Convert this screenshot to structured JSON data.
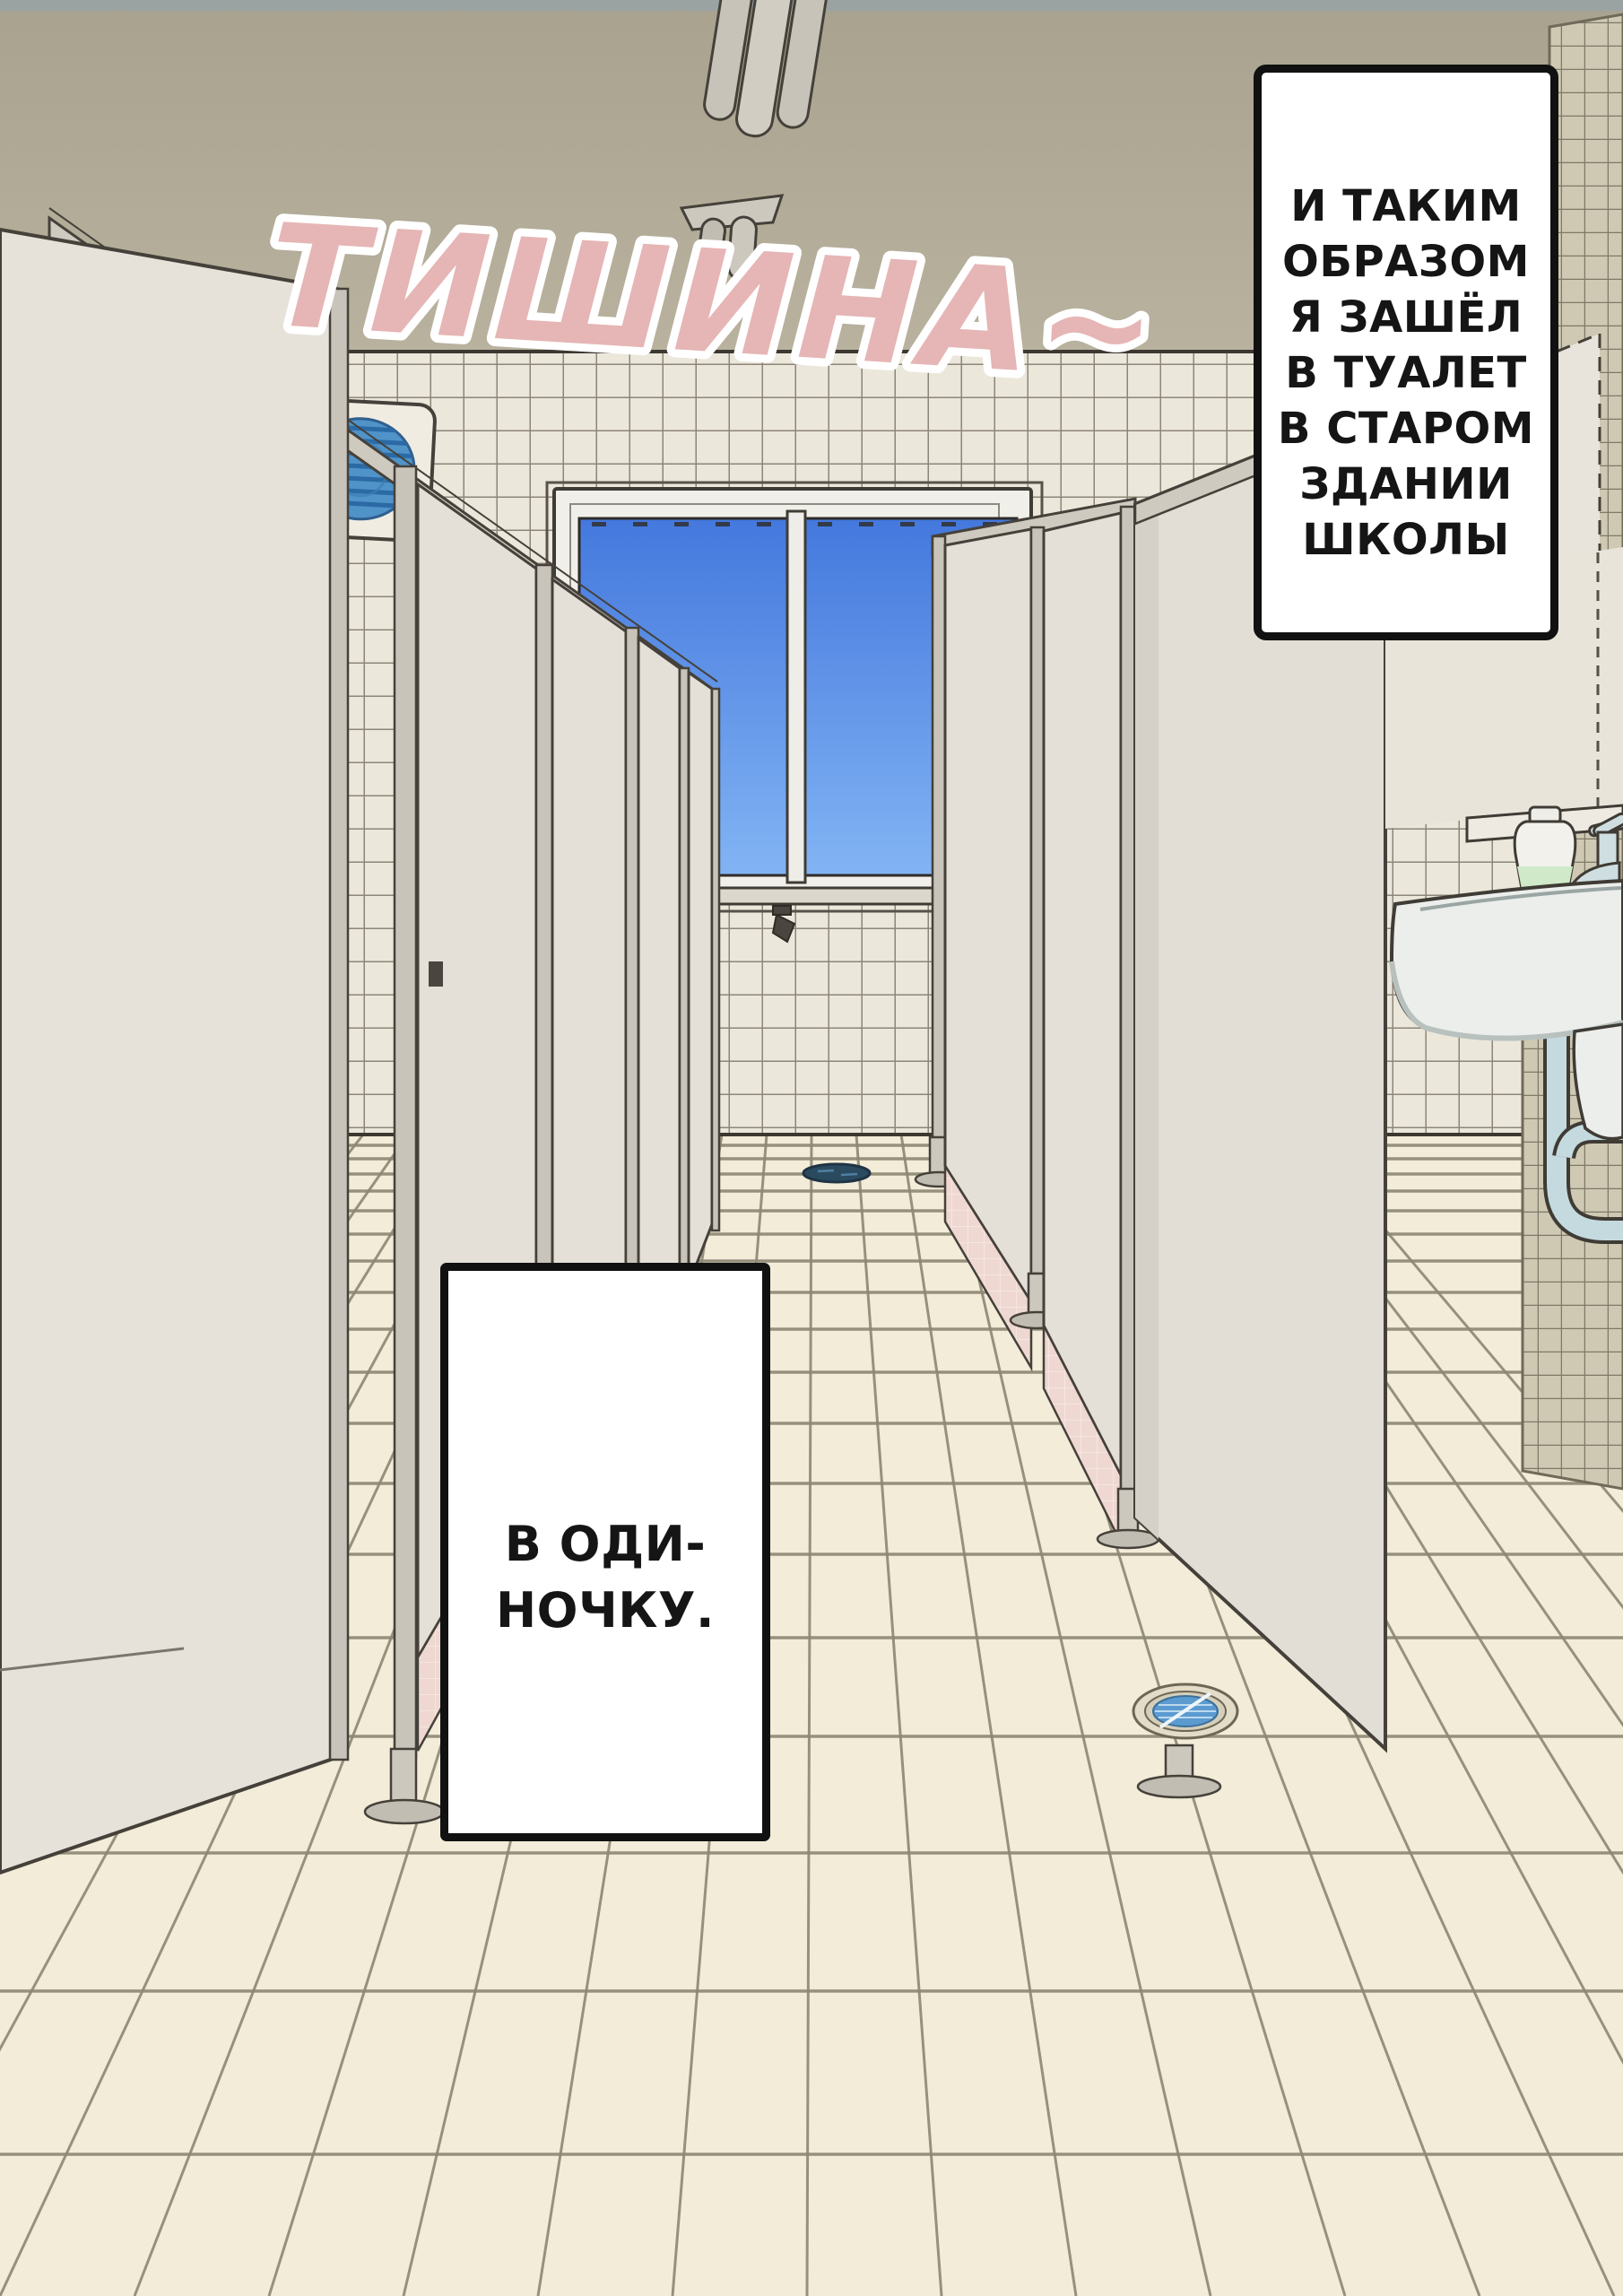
{
  "page": {
    "sfx_title": "ТИШИНА~",
    "narration_box": {
      "lines": [
        "И ТАКИМ",
        "ОБРАЗОМ",
        "Я ЗАШЁЛ",
        "В ТУАЛЕТ",
        "В СТАРОМ",
        "ЗДАНИИ",
        "ШКОЛЫ"
      ]
    },
    "caption_box": {
      "lines": [
        "В ОДИ-",
        "НОЧКУ."
      ]
    },
    "colors": {
      "sfx_pink": "#e6b5b5",
      "sfx_outline": "#ffffff",
      "sky_top": "#4478dd",
      "sky_bottom": "#82b4f4",
      "ceiling": "#b2ac98",
      "wall_tile": "#ece7db",
      "wall_grout": "#8d8678",
      "right_wall_tile": "#cfc9b3",
      "floor_tile": "#f2ecd8",
      "floor_grout": "#8d8874",
      "stall_panel": "#e4dfd7",
      "pink_skirt": "#eed8d1",
      "vent_blue": "#4f93c8",
      "drain_blue": "#5b9bd0",
      "soap_green": "#cfe9c9",
      "box_border": "#111111",
      "box_bg": "#ffffff"
    },
    "icons": {
      "ceiling_light": "fluorescent-light-icon",
      "exhaust_fan": "exhaust-fan-icon",
      "floor_drain": "floor-drain-icon",
      "faucet": "faucet-icon",
      "soap": "soap-dispenser-icon"
    }
  }
}
